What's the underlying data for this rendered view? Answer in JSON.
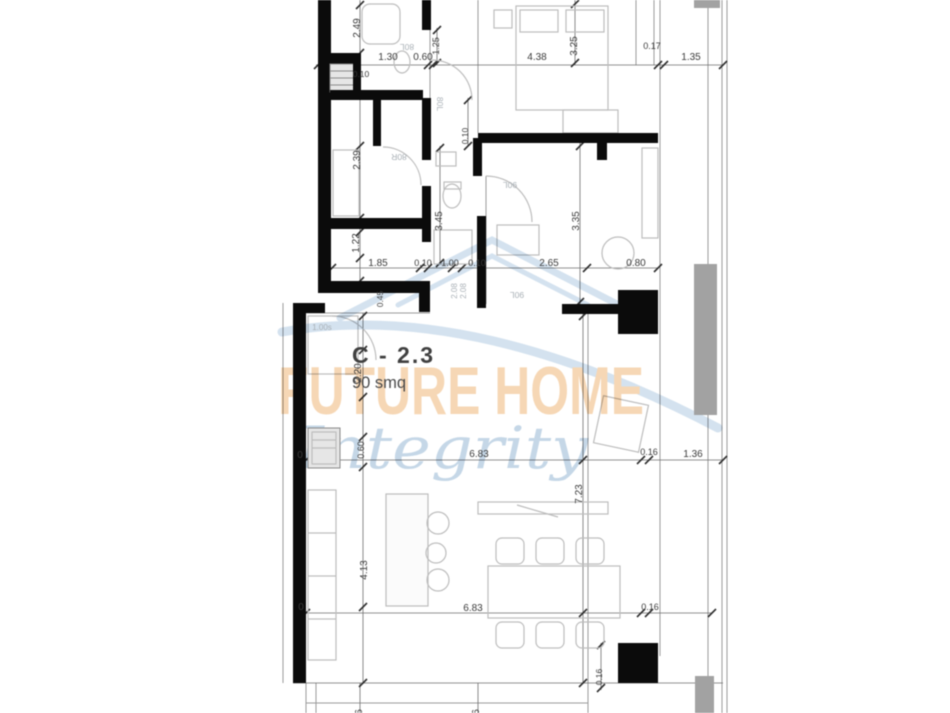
{
  "type": "floor-plan",
  "unit": {
    "label": "C - 2.3",
    "area": "90 smq"
  },
  "watermark": {
    "brand": "FUTURE HOME",
    "tagline": "Integrity",
    "brand_color": "#f4cda2",
    "tagline_color": "#b6cde1",
    "swoosh_color": "#c9dbeb"
  },
  "colors": {
    "wall": "#0b0b0b",
    "dimension_text": "#3a3a3a",
    "thin_line": "#9b9b9b",
    "furniture_line": "#bdbdbd",
    "balcony_screen": "#a2a2a2",
    "door_label": "#a9b0b6"
  },
  "labels": [
    {
      "t": "1.30",
      "x": 388,
      "y": 60
    },
    {
      "t": "0.60",
      "x": 423,
      "y": 60
    },
    {
      "t": "4.38",
      "x": 537,
      "y": 60
    },
    {
      "t": "0.17",
      "x": 652,
      "y": 49,
      "s": 9
    },
    {
      "t": "1.35",
      "x": 691,
      "y": 60
    },
    {
      "t": "0.10",
      "x": 361,
      "y": 77,
      "s": 8.5
    },
    {
      "t": "1.85",
      "x": 378,
      "y": 266
    },
    {
      "t": "0.10",
      "x": 423,
      "y": 266,
      "s": 9
    },
    {
      "t": "1.00",
      "x": 450,
      "y": 266,
      "s": 9
    },
    {
      "t": "0.10",
      "x": 477,
      "y": 266,
      "s": 9
    },
    {
      "t": "2.65",
      "x": 549,
      "y": 266
    },
    {
      "t": "0.80",
      "x": 636,
      "y": 266
    },
    {
      "t": "6.83",
      "x": 479,
      "y": 457
    },
    {
      "t": "0.16",
      "x": 649,
      "y": 455,
      "s": 9
    },
    {
      "t": "1.36",
      "x": 693,
      "y": 457
    },
    {
      "t": "6.83",
      "x": 473,
      "y": 611
    },
    {
      "t": "0.16",
      "x": 650,
      "y": 610,
      "s": 9
    },
    {
      "t": "2.49",
      "x": 360,
      "y": 28,
      "r": -90
    },
    {
      "t": "2.39",
      "x": 360,
      "y": 160,
      "r": -90
    },
    {
      "t": "1.22",
      "x": 359,
      "y": 243,
      "r": -90
    },
    {
      "t": "0.45",
      "x": 383,
      "y": 299,
      "r": -90,
      "s": 8.5
    },
    {
      "t": "3.45",
      "x": 442,
      "y": 221,
      "r": -90
    },
    {
      "t": "3.35",
      "x": 579,
      "y": 221,
      "r": -90
    },
    {
      "t": "3.25",
      "x": 577,
      "y": 46,
      "r": -90
    },
    {
      "t": "1.25",
      "x": 439,
      "y": 46,
      "r": -90,
      "s": 9
    },
    {
      "t": "0.10",
      "x": 468,
      "y": 136,
      "r": -90,
      "s": 8.5
    },
    {
      "t": "2.20",
      "x": 361,
      "y": 373,
      "r": -90
    },
    {
      "t": "0.60",
      "x": 364,
      "y": 450,
      "r": -90,
      "s": 9
    },
    {
      "t": "4.13",
      "x": 367,
      "y": 570,
      "r": -90
    },
    {
      "t": "7.23",
      "x": 582,
      "y": 494,
      "r": -90
    },
    {
      "t": "0.16",
      "x": 602,
      "y": 677,
      "r": -90,
      "s": 8.5
    },
    {
      "t": "0",
      "x": 300,
      "y": 458
    },
    {
      "t": "0",
      "x": 301,
      "y": 610
    },
    {
      "t": "6",
      "x": 362,
      "y": 712,
      "r": -90
    },
    {
      "t": "6",
      "x": 479,
      "y": 712,
      "r": -90
    },
    {
      "t": "80L",
      "x": 407,
      "y": 44,
      "r": 180,
      "c": "door",
      "s": 8.5
    },
    {
      "t": "80L",
      "x": 437,
      "y": 104,
      "r": 90,
      "c": "door",
      "s": 8.5
    },
    {
      "t": "80R",
      "x": 399,
      "y": 154,
      "r": 180,
      "c": "door",
      "s": 8.5
    },
    {
      "t": "90L",
      "x": 510,
      "y": 182,
      "r": 180,
      "c": "door",
      "s": 8.5
    },
    {
      "t": "90L",
      "x": 517,
      "y": 292,
      "r": 180,
      "c": "door",
      "s": 8.5
    },
    {
      "t": "1.00s",
      "x": 322,
      "y": 330,
      "c": "door",
      "s": 8
    },
    {
      "t": "2.08",
      "x": 457,
      "y": 291,
      "r": -90,
      "c": "door",
      "s": 8
    },
    {
      "t": "2.08",
      "x": 466,
      "y": 291,
      "r": -90,
      "c": "door",
      "s": 8
    }
  ]
}
